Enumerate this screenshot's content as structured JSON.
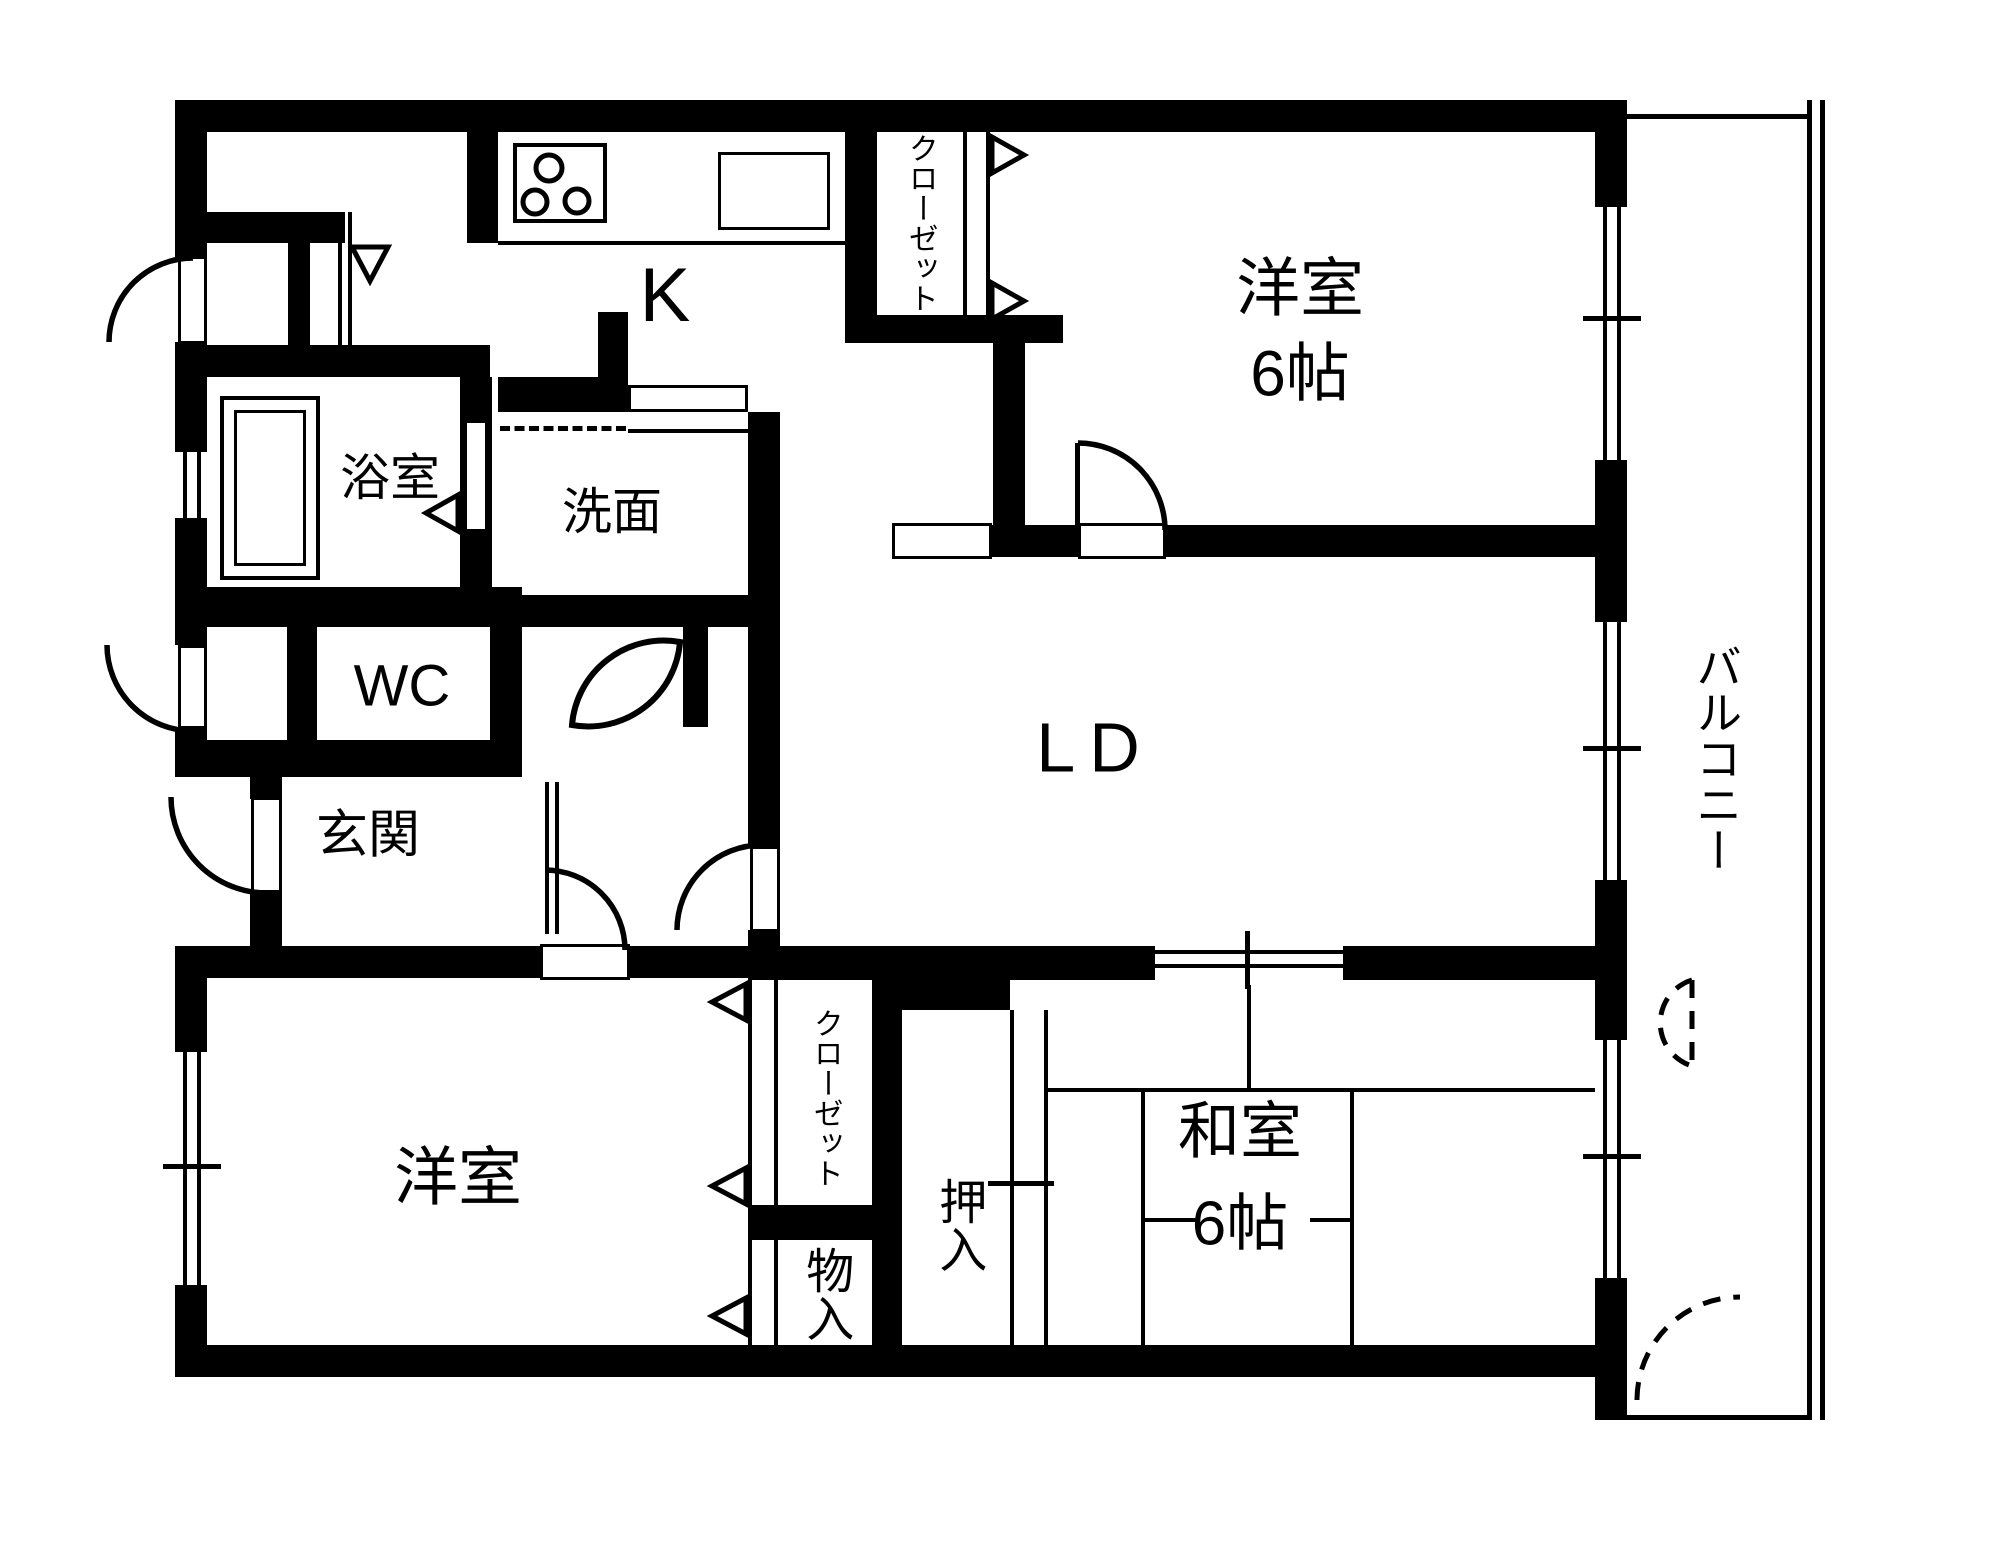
{
  "plan": {
    "colors": {
      "background": "#ffffff",
      "lines": "#000000"
    },
    "rooms": {
      "kitchen": {
        "label": "K"
      },
      "western_room_top": {
        "label": "洋室",
        "size": "6帖"
      },
      "closet_top": {
        "label": "クローゼット"
      },
      "bathroom": {
        "label": "浴室"
      },
      "washroom": {
        "label": "洗面"
      },
      "toilet": {
        "label": "WC"
      },
      "entrance": {
        "label": "玄関"
      },
      "living_dining": {
        "label": "LD"
      },
      "balcony": {
        "label": "バルコニー"
      },
      "western_room_bottom": {
        "label": "洋室"
      },
      "closet_bottom": {
        "label": "クローゼット"
      },
      "storage": {
        "label": "物入"
      },
      "oshiire": {
        "label": "押入"
      },
      "japanese_room": {
        "label": "和室",
        "size": "6帖"
      }
    }
  }
}
